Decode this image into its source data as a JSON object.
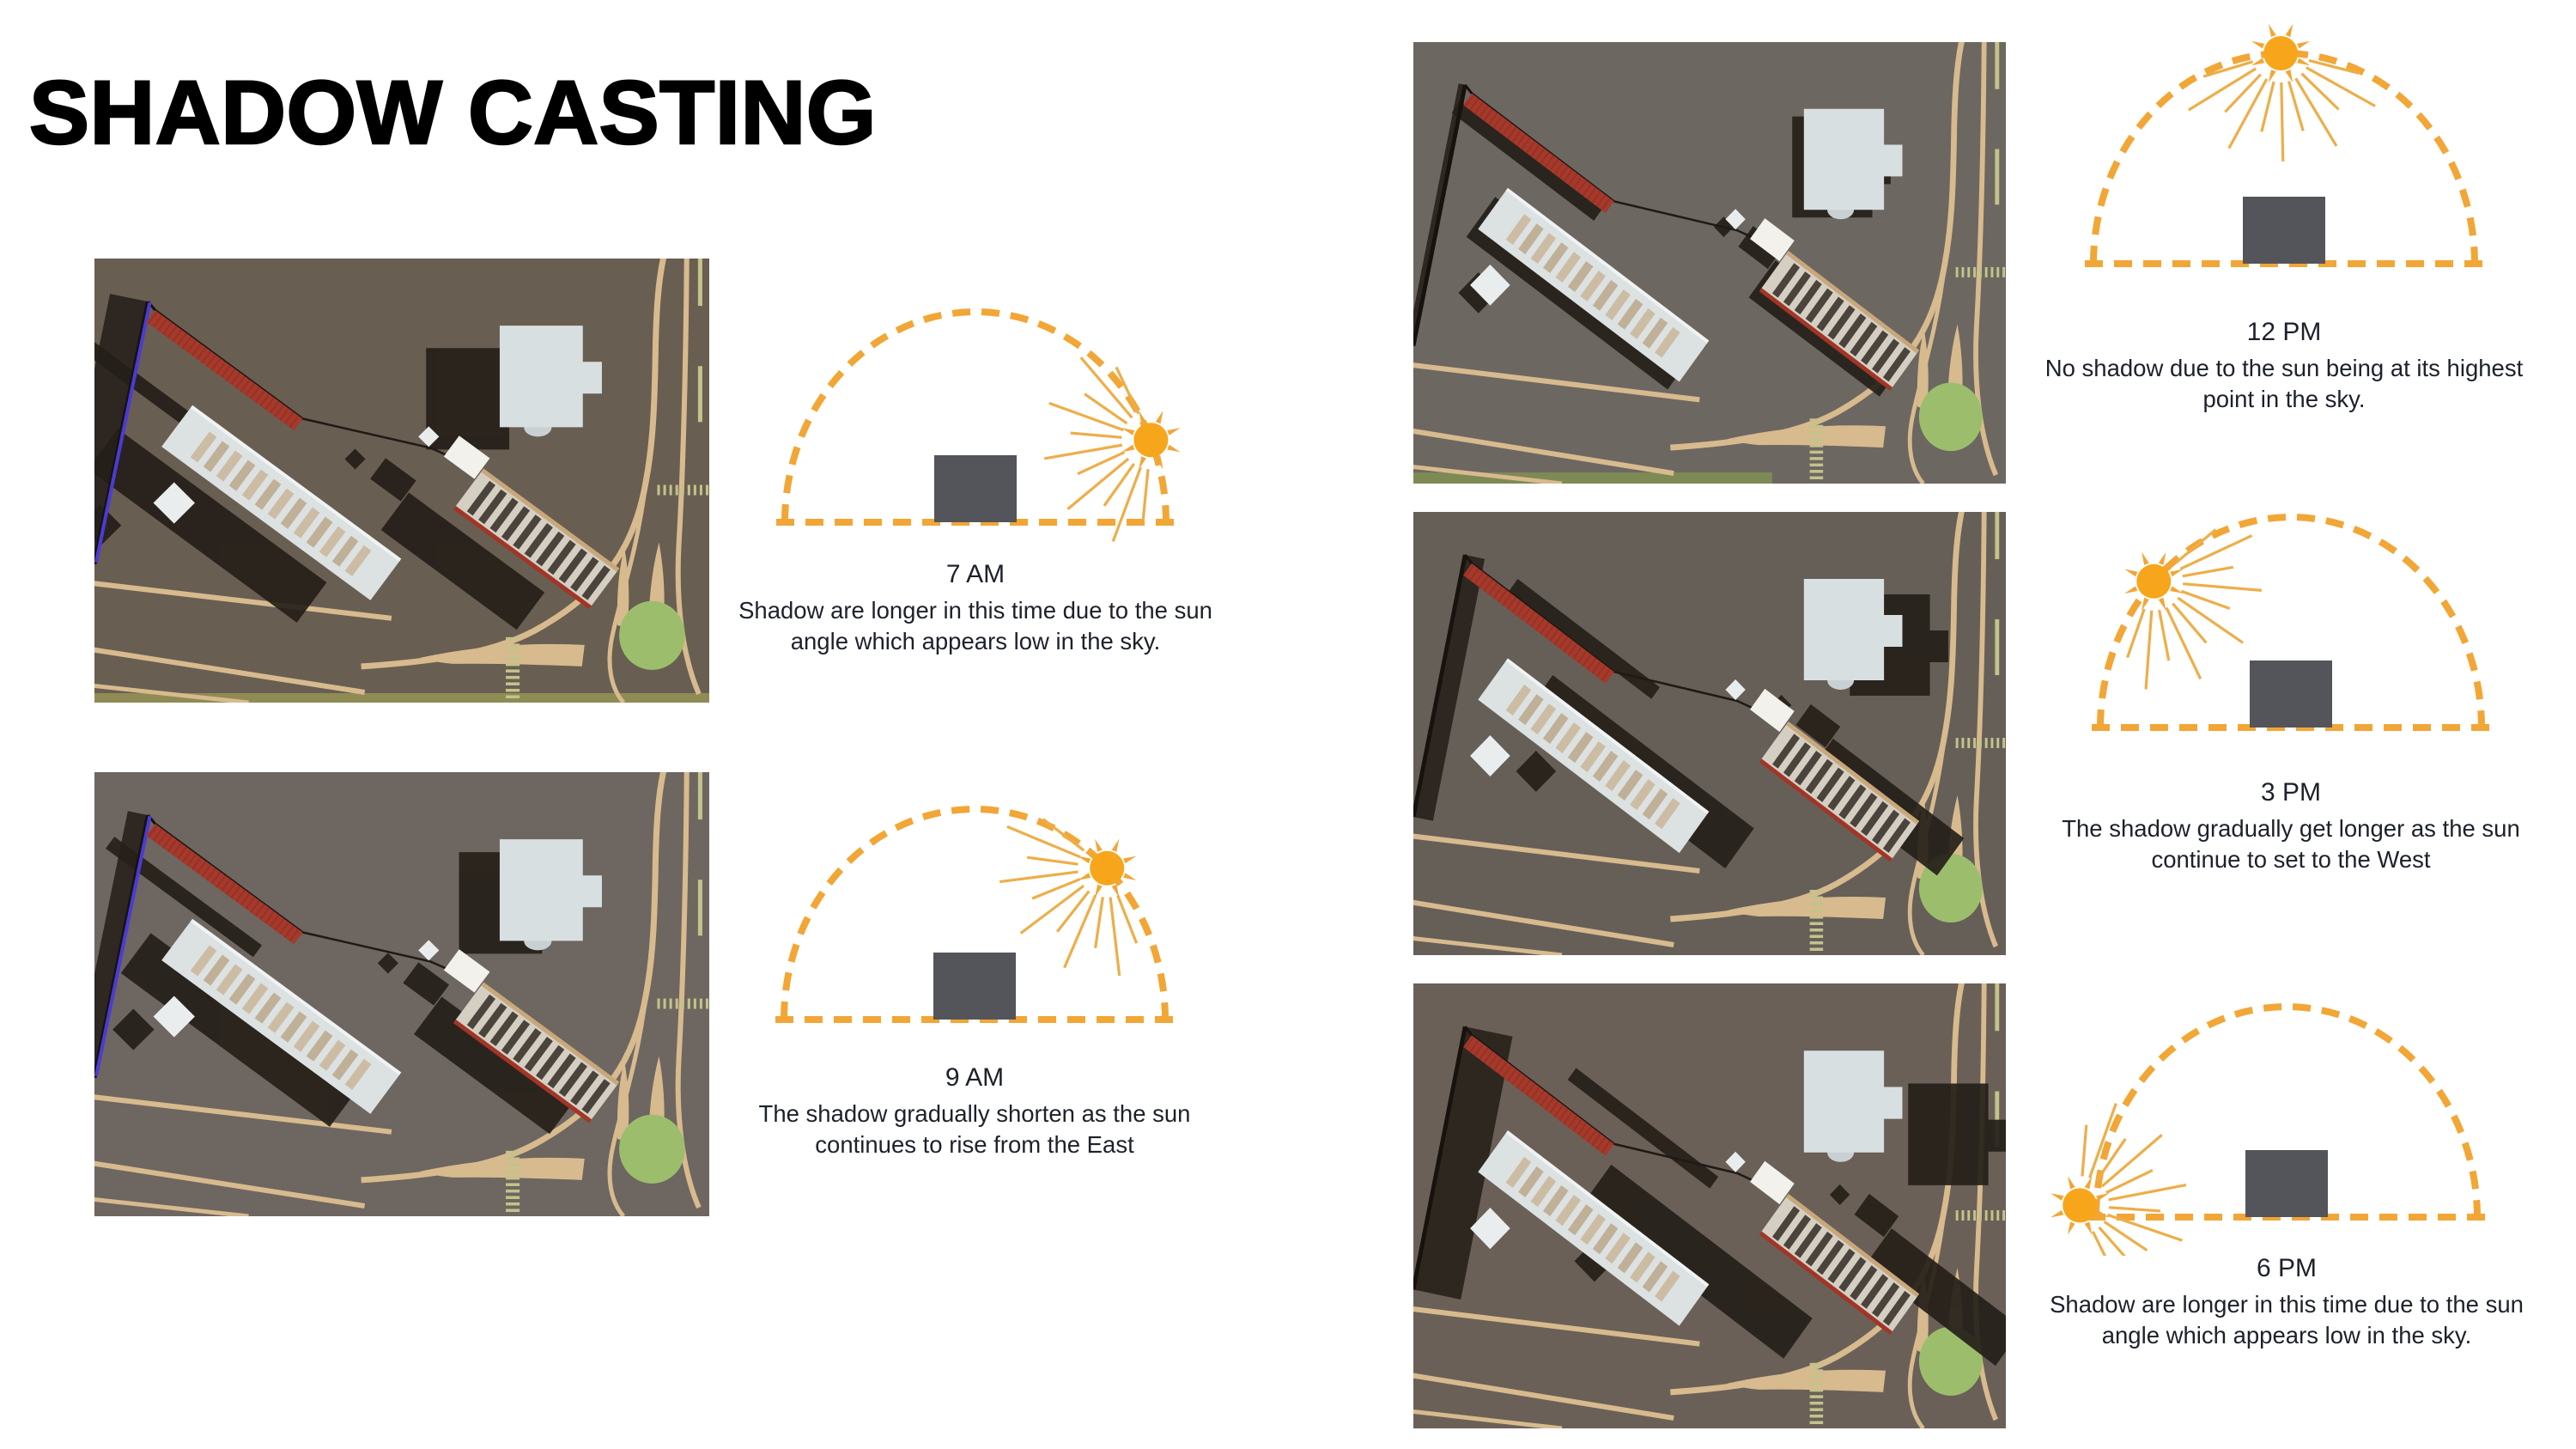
{
  "title": "SHADOW CASTING",
  "colors": {
    "accent_orange": "#F2A636",
    "sun_core": "#F7A61B",
    "sun_rays": "#EDAE49",
    "diagram_building": "#54555A",
    "text": "#1C212B",
    "shadow": "#251F19",
    "road_tan": "#D7BA8E",
    "tree_green": "#9CBE6C",
    "roof_red": "#A5392B",
    "fence_blue": "#4B3BD6"
  },
  "panels": [
    {
      "id": "am7",
      "time": "7 AM",
      "caption": "Shadow are longer in this time due to the sun\nangle which appears low in the sky.",
      "sun_angle_deg": 23
    },
    {
      "id": "am9",
      "time": "9 AM",
      "caption": "The shadow gradually shorten as the sun\ncontinues to rise from the East",
      "sun_angle_deg": 46
    },
    {
      "id": "pm12",
      "time": "12 PM",
      "caption": "No shadow due to the sun being at its highest\npoint in the sky.",
      "sun_angle_deg": 91
    },
    {
      "id": "pm3",
      "time": "3 PM",
      "caption": "The shadow gradually get longer as the sun\ncontinue to set to the West",
      "sun_angle_deg": 136
    },
    {
      "id": "pm6",
      "time": "6 PM",
      "caption": "Shadow are longer in this time due to the sun\nangle which appears low in the sky.",
      "sun_angle_deg": 174
    }
  ],
  "renders": [
    {
      "id": "r7",
      "time": "7 AM",
      "ground": "#695E52",
      "shadow_dx": -85,
      "shadow_dy": 26,
      "fence_shadow": -45,
      "grass": "full",
      "blue_fence": true
    },
    {
      "id": "r9",
      "time": "9 AM",
      "ground": "#6E6660",
      "shadow_dx": -47,
      "shadow_dy": 15,
      "fence_shadow": -24,
      "grass": "none",
      "blue_fence": true
    },
    {
      "id": "r12",
      "time": "12 PM",
      "ground": "#6D6761",
      "shadow_dx": -14,
      "shadow_dy": 9,
      "fence_shadow": -8,
      "grass": "left",
      "blue_fence": false
    },
    {
      "id": "r3",
      "time": "3 PM",
      "ground": "#665F58",
      "shadow_dx": 55,
      "shadow_dy": 18,
      "fence_shadow": 24,
      "grass": "none",
      "blue_fence": false
    },
    {
      "id": "r6",
      "time": "6 PM",
      "ground": "#6A6057",
      "shadow_dx": 125,
      "shadow_dy": 38,
      "fence_shadow": 58,
      "grass": "none",
      "blue_fence": false
    }
  ]
}
